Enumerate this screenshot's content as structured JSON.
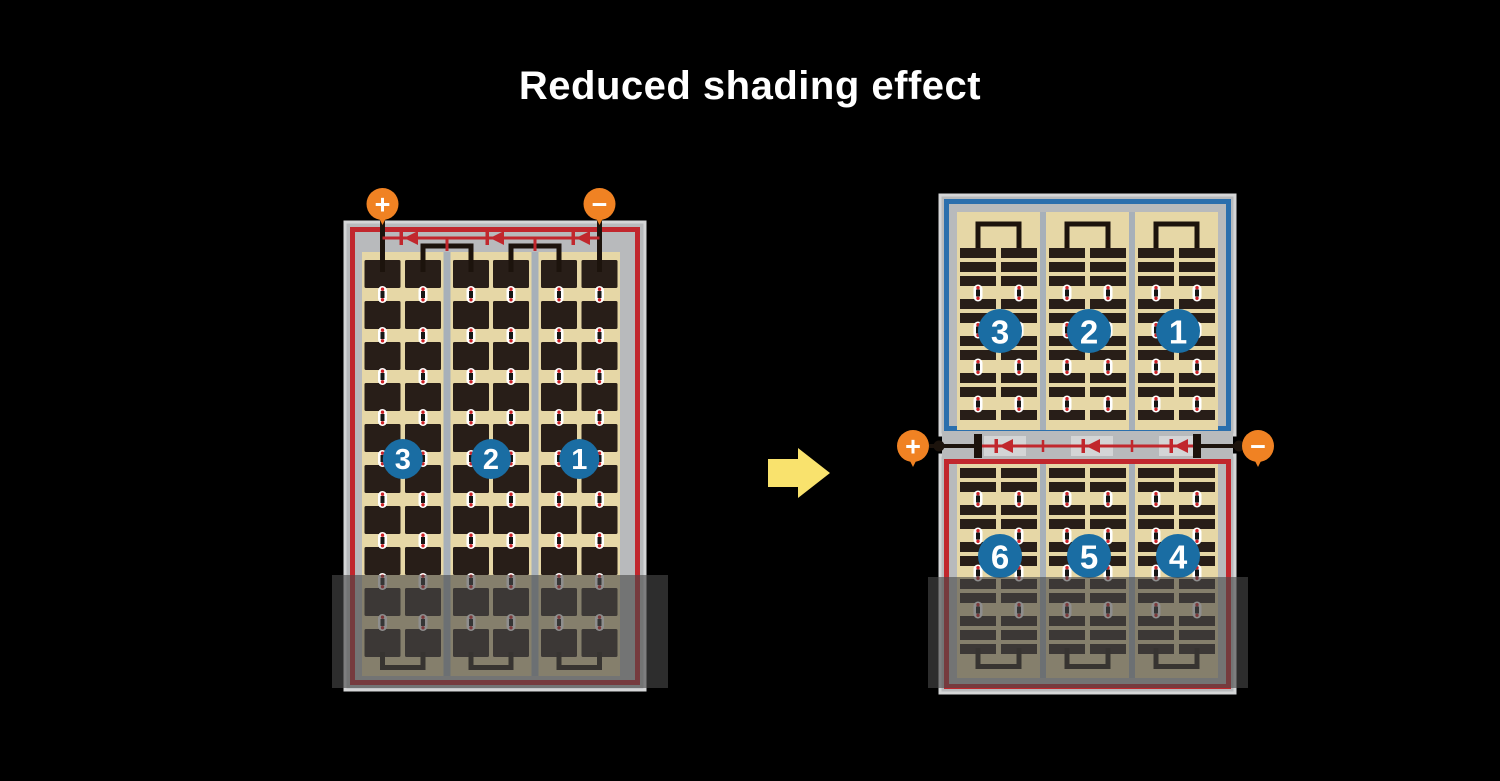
{
  "title": "Reduced shading effect",
  "colors": {
    "background": "#000000",
    "title_text": "#ffffff",
    "frame_gray": "#b8babc",
    "frame_edge": "#d5d6d7",
    "divider_gray": "#a7b0b9",
    "cell_field_tan": "#e6d7a6",
    "cell_dark": "#281e18",
    "wire_black": "#1c130c",
    "border_red": "#c1272d",
    "border_blue": "#2b6fad",
    "diode_red": "#c1272d",
    "channel_light": "#d4d5d6",
    "terminal_orange": "#f08223",
    "badge_blue": "#1a6da3",
    "badge_text": "#ffffff",
    "connector_white": "#ffffff",
    "connector_bar": "#161616",
    "connector_dot_red": "#cc2127",
    "shading_overlay": "rgba(72,72,72,0.62)",
    "arrow_yellow": "#f9e26d"
  },
  "left_module": {
    "terminals": [
      {
        "symbol": "+"
      },
      {
        "symbol": "−"
      }
    ],
    "strings": [
      {
        "label": "3"
      },
      {
        "label": "2"
      },
      {
        "label": "1"
      }
    ],
    "bypass_diode_count": 3
  },
  "right_module": {
    "terminals": [
      {
        "symbol": "+"
      },
      {
        "symbol": "−"
      }
    ],
    "top_half_strings": [
      {
        "label": "3"
      },
      {
        "label": "2"
      },
      {
        "label": "1"
      }
    ],
    "bottom_half_strings": [
      {
        "label": "6"
      },
      {
        "label": "5"
      },
      {
        "label": "4"
      }
    ],
    "bypass_diode_count": 3
  }
}
